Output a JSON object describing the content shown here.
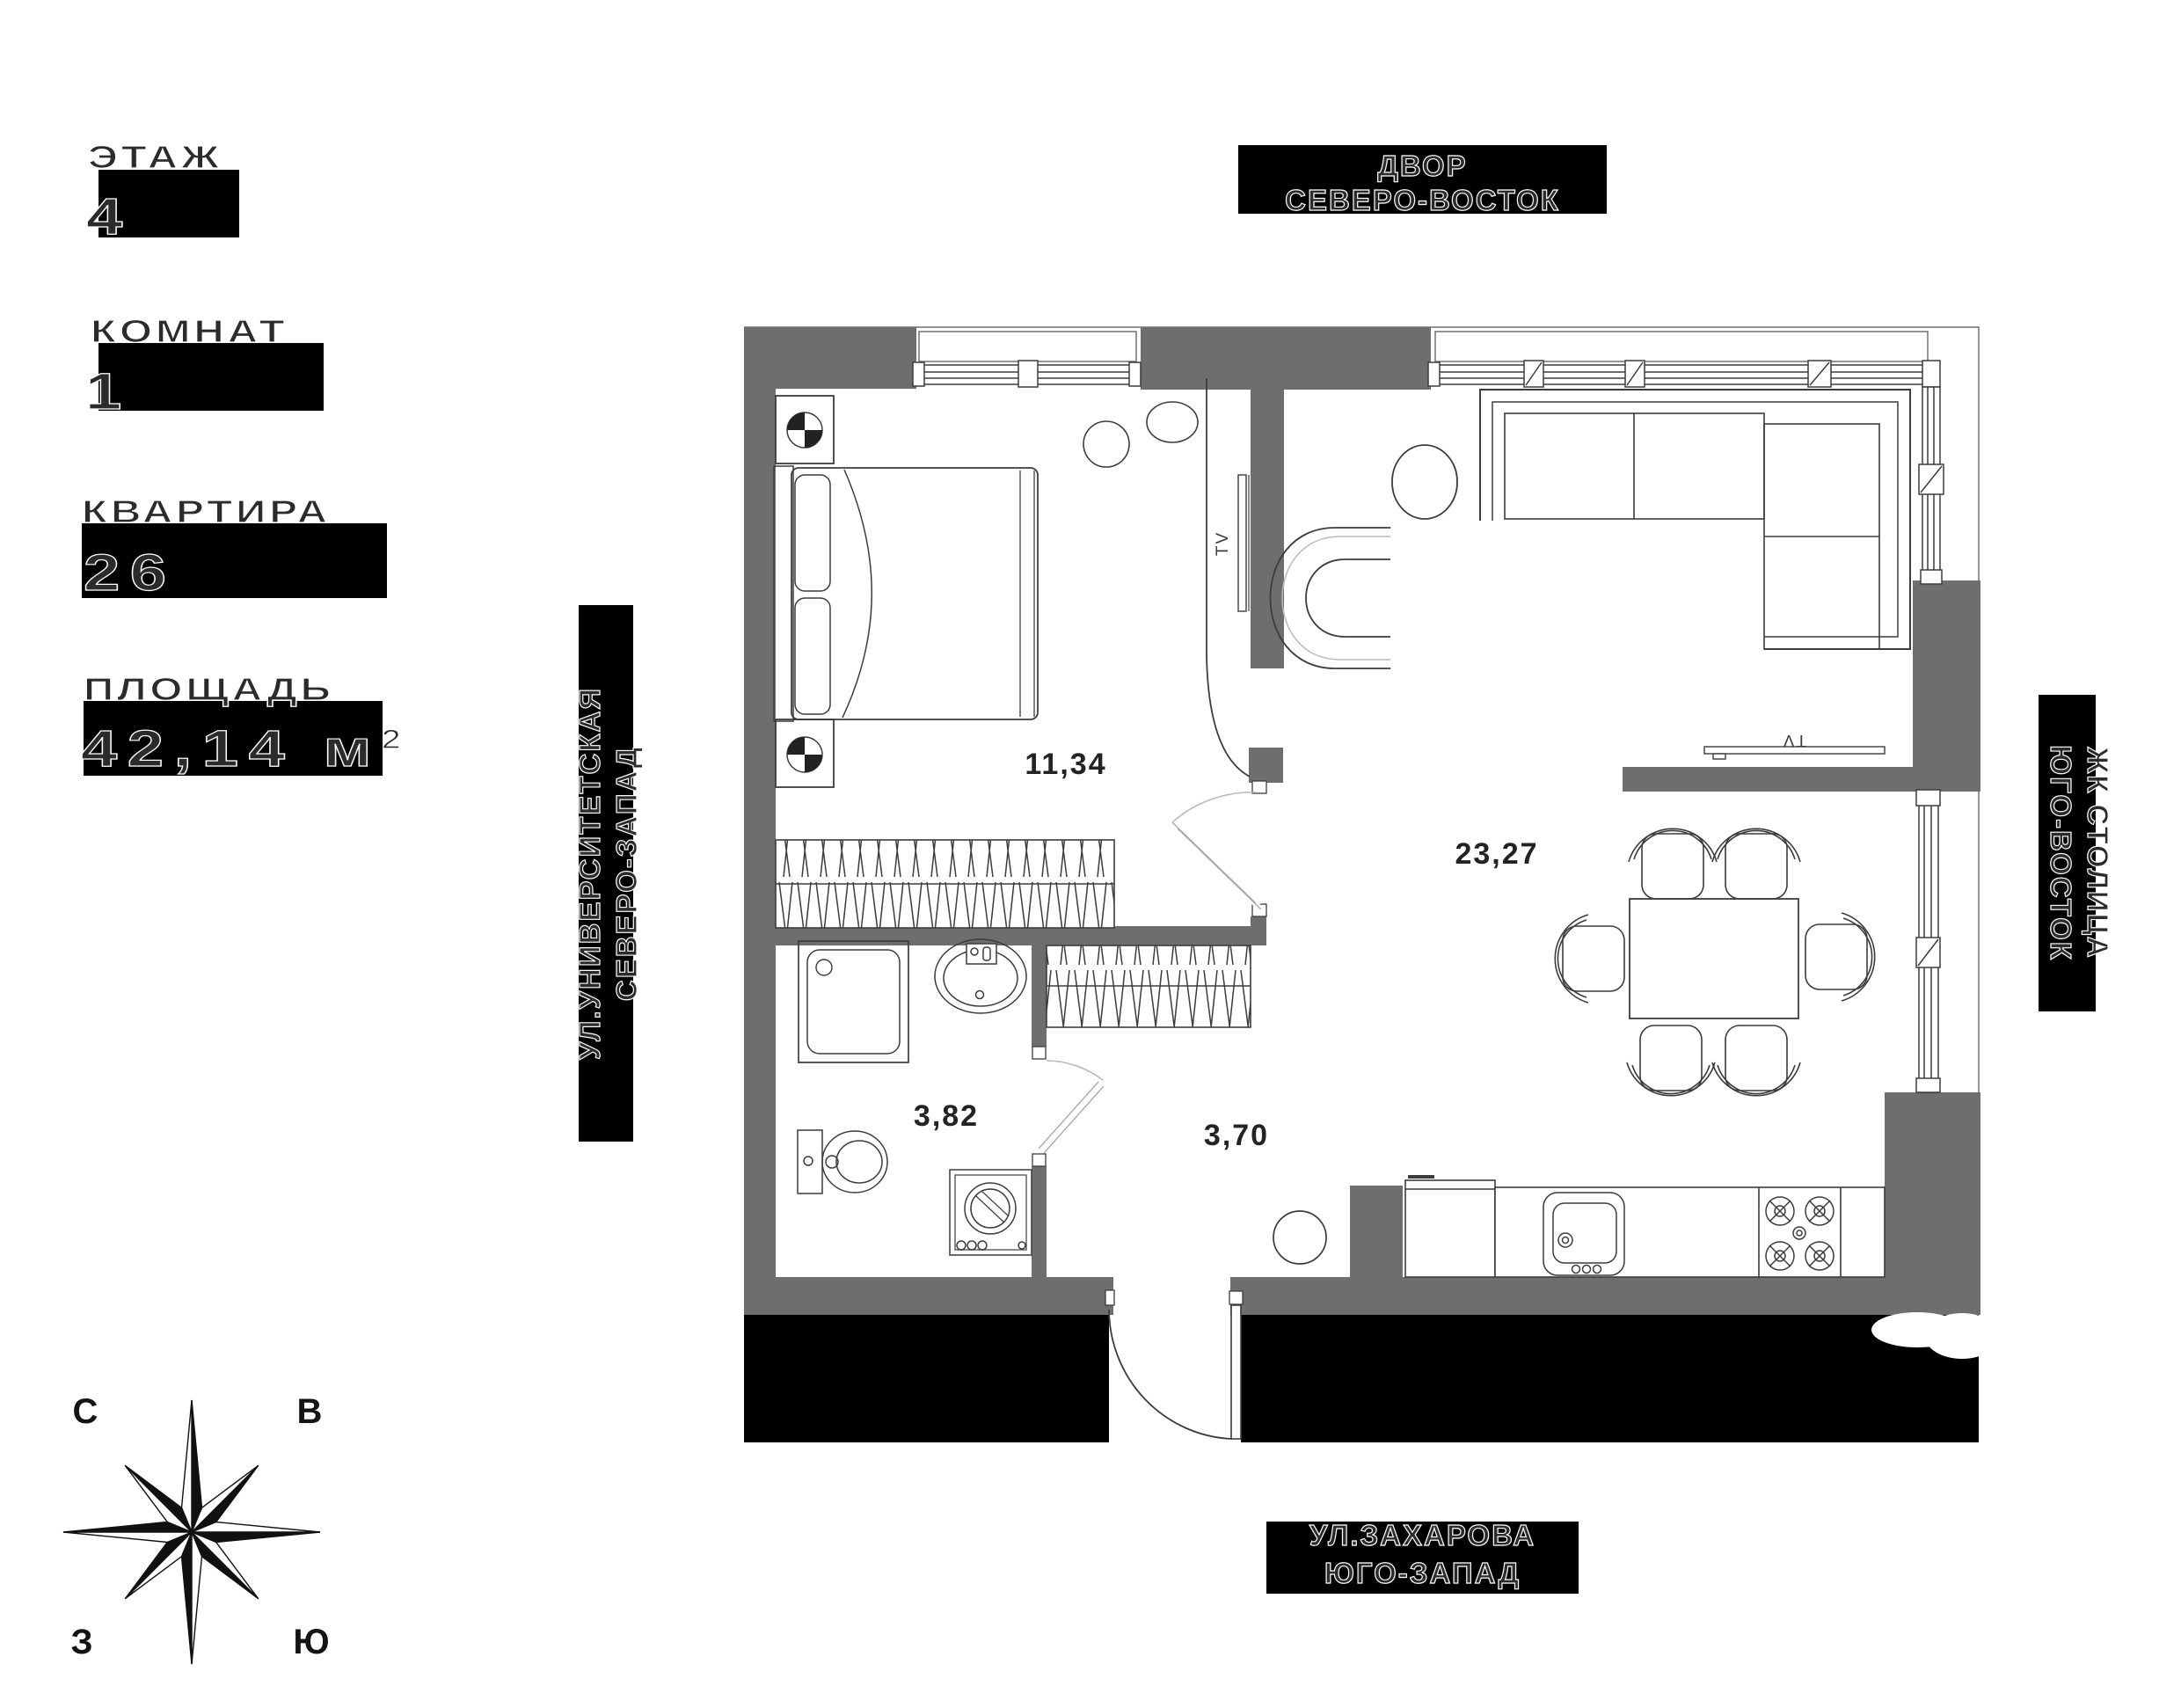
{
  "colors": {
    "wall_gray": "#6e6e70",
    "common_area_black": "#000000",
    "line_dark": "#3c3c3e",
    "line_light": "#b9b9bb",
    "label_text": "#2b2b2d"
  },
  "info": {
    "floor": {
      "label": "ЭТАЖ",
      "value": "4"
    },
    "rooms": {
      "label": "КОМНАТ",
      "value": "1"
    },
    "apartment": {
      "label": "КВАРТИРА",
      "value": "26"
    },
    "area": {
      "label": "ПЛОЩАДЬ",
      "value": "42,14",
      "unit": "м",
      "sup": "2"
    }
  },
  "orientation": {
    "top": {
      "line1": "ДВОР",
      "line2": "СЕВЕРО-ВОСТОК"
    },
    "left": {
      "line1": "УЛ.УНИВЕРСИТЕТСКАЯ",
      "line2": "СЕВЕРО-ЗАПАД"
    },
    "right": {
      "line1": "ЖК СТОЛИЦА",
      "line2": "ЮГО-ВОСТОК"
    },
    "bottom": {
      "line1": "УЛ.ЗАХАРОВА",
      "line2": "ЮГО-ЗАПАД"
    }
  },
  "compass": {
    "nw": "С",
    "ne": "В",
    "sw": "З",
    "se": "Ю"
  },
  "plan": {
    "tv_label": "TV",
    "rooms": [
      {
        "name": "bedroom",
        "area": "11,34"
      },
      {
        "name": "living-kitchen",
        "area": "23,27"
      },
      {
        "name": "bathroom",
        "area": "3,82"
      },
      {
        "name": "hall",
        "area": "3,70"
      }
    ]
  }
}
